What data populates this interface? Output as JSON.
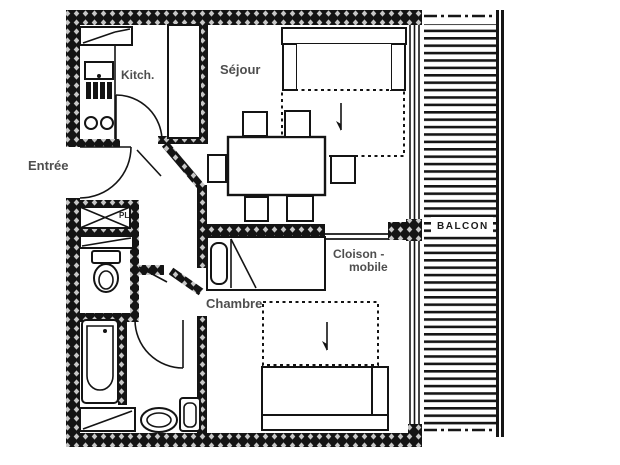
{
  "drawing": {
    "type": "apartment-floor-plan",
    "background": "#ffffff"
  },
  "colors": {
    "wall": "#141414",
    "wall_hatch_dot": "#f4f4f4",
    "label_gray": "#4e4e4e",
    "line": "#141414"
  },
  "labels": {
    "entree": "Entrée",
    "kitchen": "Kitch.",
    "sejour": "Séjour",
    "chambre": "Chambre",
    "cloison_line1": "Cloison -",
    "cloison_line2": "mobile",
    "balcon": "BALCON",
    "placard": "PL"
  },
  "rooms": [
    {
      "name": "entrance",
      "label": "Entrée",
      "furniture": [
        "entry-door",
        "closet-pl",
        "shoe-shelf"
      ]
    },
    {
      "name": "kitchen",
      "label": "Kitch.",
      "furniture": [
        "counter",
        "sink-unit",
        "stove-grill",
        "two-burners",
        "wall-cupboard"
      ]
    },
    {
      "name": "living-room",
      "label": "Séjour",
      "furniture": [
        "sofa",
        "fold-out-bed-dashed",
        "dining-table",
        "six-chairs"
      ]
    },
    {
      "name": "wc",
      "label": "",
      "furniture": [
        "toilet"
      ]
    },
    {
      "name": "bathroom",
      "label": "",
      "furniture": [
        "bathtub",
        "washbasin",
        "small-basin",
        "cabinet"
      ]
    },
    {
      "name": "bedroom",
      "label": "Chambre",
      "furniture": [
        "single-bed",
        "fold-out-bed-dashed",
        "sofa"
      ]
    },
    {
      "name": "balcony",
      "label": "BALCON",
      "furniture": [
        "deck-slats"
      ]
    }
  ],
  "partition": {
    "label": "Cloison - mobile",
    "style": "thin-double-line"
  }
}
